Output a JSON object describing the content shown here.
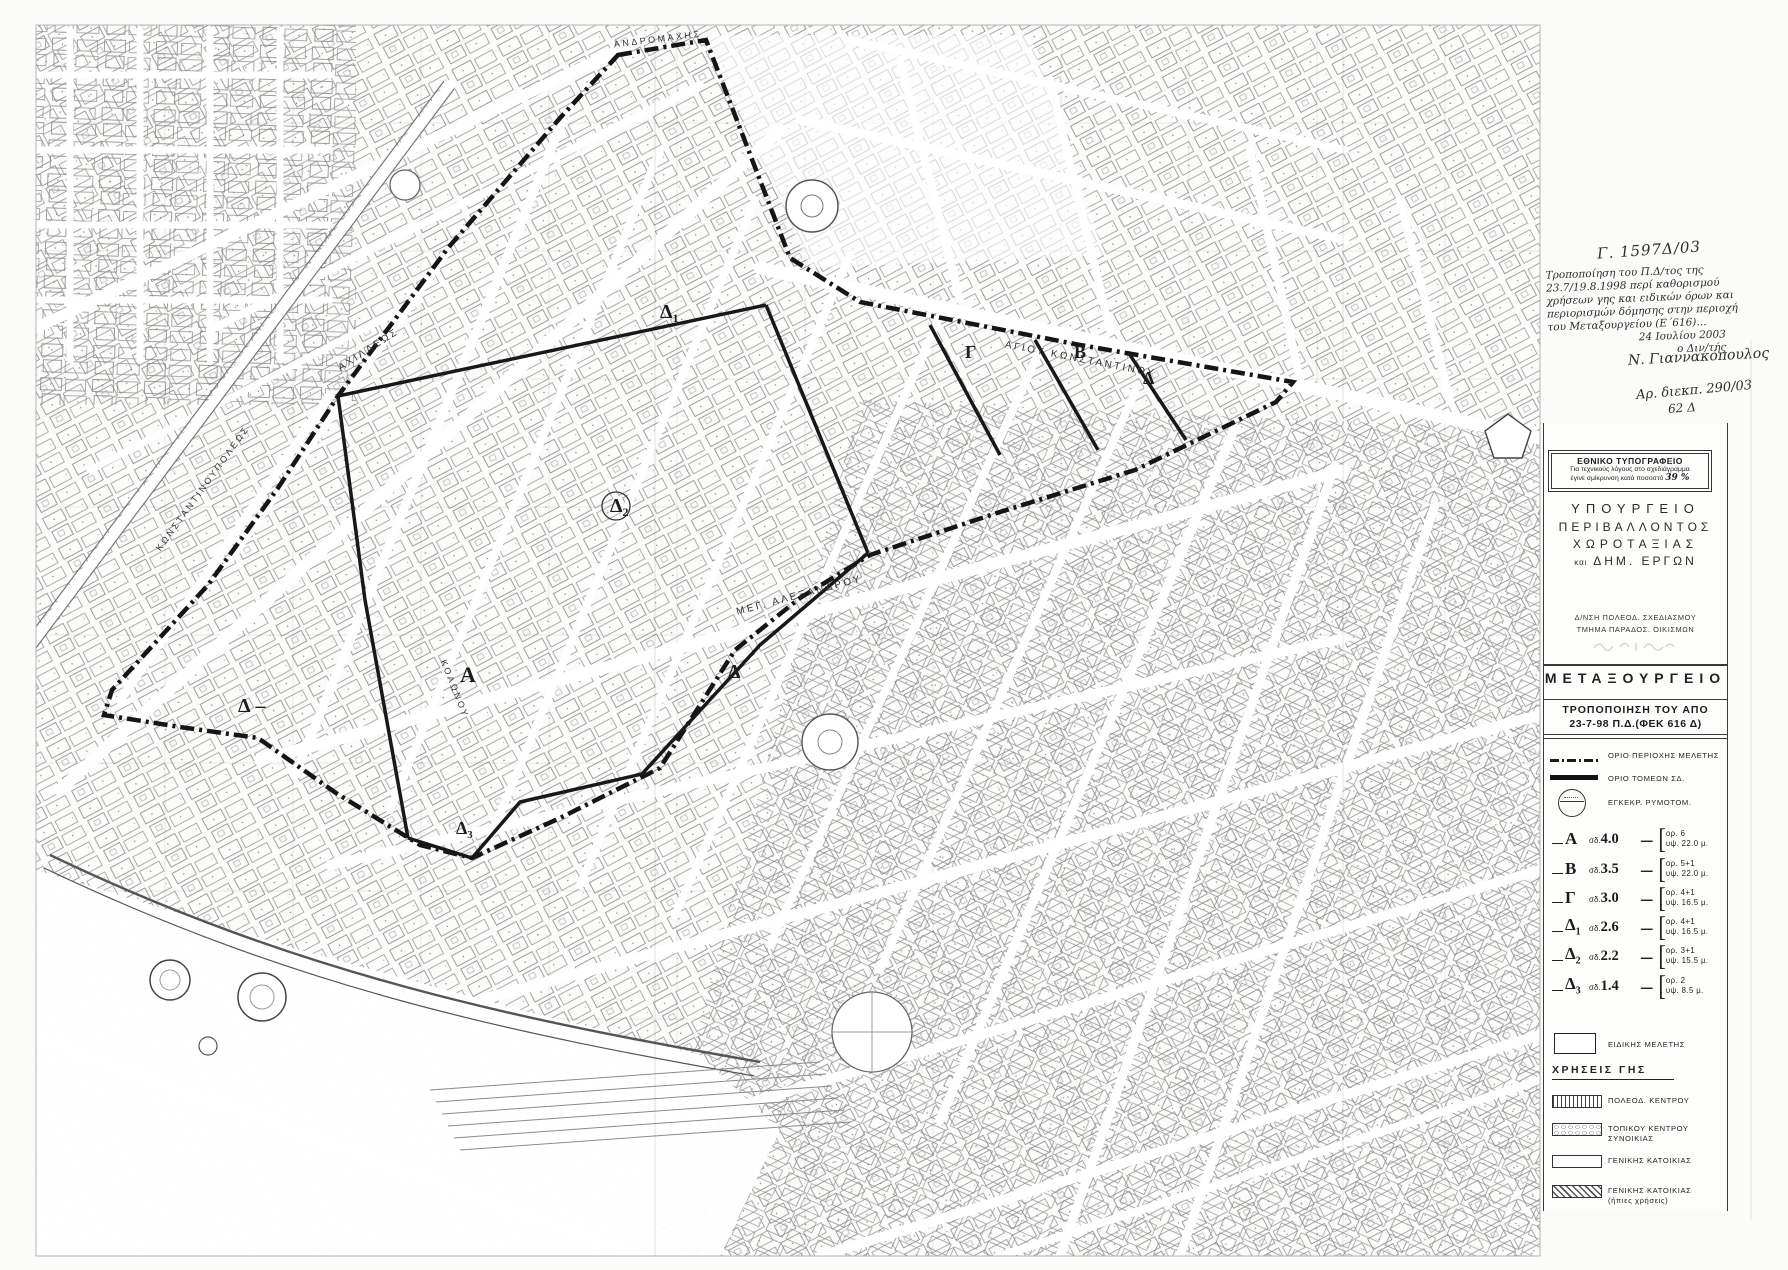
{
  "colors": {
    "ink": "#1b1b1b",
    "scan_gray": "#6b6b6b",
    "paper": "#fbfbfa",
    "boundary": "#151515"
  },
  "annotations": {
    "ref_number": "Γ. 1597Δ/03",
    "note_lines": [
      "Τροποποίηση του Π.Δ/τος της",
      "23.7/19.8.1998 περί καθορισμού",
      "χρήσεων γης και ειδικών όρων και",
      "περιορισμών δόμησης στην περιοχή",
      "του Μεταξουργείου (Ε΄616)..."
    ],
    "note_right_lines": [
      "24 Ιουλίου 2003",
      "ο Διν/τής"
    ],
    "signature": "Ν. Γιαννακόπουλος",
    "docket": "Αρ. διεκπ. 290/03",
    "docket2": "62 Δ"
  },
  "stamp": {
    "line1": "ΕΘΝΙΚΟ ΤΥΠΟΓΡΑΦΕΙΟ",
    "line2": "Για τεχνικούς λόγους στο σχεδιάγραμμα",
    "line3": "έγινε σμίκρυνση κατά ποσοστό",
    "percent": "39 %"
  },
  "title_block": {
    "ministry_line1": "ΥΠΟΥΡΓΕΙΟ",
    "ministry_line2": "ΠΕΡΙΒΑΛΛΟΝΤΟΣ",
    "ministry_line3": "ΧΩΡΟΤΑΞΙΑΣ",
    "ministry_line4_small": "και",
    "ministry_line4": "ΔΗΜ. ΕΡΓΩΝ",
    "dept_line1": "Δ/ΝΣΗ ΠΟΛΕΟΔ. ΣΧΕΔΙΑΣΜΟΥ",
    "dept_line2": "ΤΜΗΜΑ ΠΑΡΑΔΟΣ. ΟΙΚΙΣΜΩΝ",
    "project": "ΜΕΤΑΞΟΥΡΓΕΙΟ",
    "subtitle1": "ΤΡΟΠΟΠΟΙΗΣΗ ΤΟΥ ΑΠΟ",
    "subtitle2": "23-7-98 Π.Δ.(ΦΕΚ 616 Δ)"
  },
  "legend": {
    "boundary_items": [
      {
        "symbol": "dash-dot-line",
        "label": "ΟΡΙΟ ΠΕΡΙΟΧΗΣ ΜΕΛΕΤΗΣ"
      },
      {
        "symbol": "thick-line",
        "label": "ΟΡΙΟ ΤΟΜΕΩΝ ΣΔ."
      },
      {
        "symbol": "approval-seal",
        "label": "ΕΓΚΕΚΡ. ΡΥΜΟΤΟΜ."
      }
    ],
    "sd_prefix": "σδ.",
    "zones": [
      {
        "zone": "Α",
        "sub": "",
        "sd": "4.0",
        "floors": "ορ. 6",
        "height": "υψ. 22.0 μ."
      },
      {
        "zone": "Β",
        "sub": "",
        "sd": "3.5",
        "floors": "ορ. 5+1",
        "height": "υψ. 22.0 μ."
      },
      {
        "zone": "Γ",
        "sub": "",
        "sd": "3.0",
        "floors": "ορ. 4+1",
        "height": "υψ. 16.5 μ."
      },
      {
        "zone": "Δ",
        "sub": "1",
        "sd": "2.6",
        "floors": "ορ. 4+1",
        "height": "υψ. 16.5 μ."
      },
      {
        "zone": "Δ",
        "sub": "2",
        "sd": "2.2",
        "floors": "ορ. 3+1",
        "height": "υψ. 15.5 μ."
      },
      {
        "zone": "Δ",
        "sub": "3",
        "sd": "1.4",
        "floors": "ορ. 2",
        "height": "υψ. 8.5 μ."
      }
    ],
    "special_item_label": "ΕΙΔΙΚΗΣ ΜΕΛΕΤΗΣ",
    "land_use_header": "ΧΡΗΣΕΙΣ ΓΗΣ",
    "land_uses": [
      {
        "pattern": "pat-vhatch",
        "label": "ΠΟΛΕΟΔ. ΚΕΝΤΡΟΥ",
        "label2": ""
      },
      {
        "pattern": "pat-ovals",
        "label": "ΤΟΠΙΚΟΥ ΚΕΝΤΡΟΥ",
        "label2": "ΣΥΝΟΙΚΙΑΣ"
      },
      {
        "pattern": "",
        "label": "ΓΕΝΙΚΗΣ ΚΑΤΟΙΚΙΑΣ",
        "label2": ""
      },
      {
        "pattern": "pat-diag",
        "label": "ΓΕΝΙΚΗΣ ΚΑΤΟΙΚΙΑΣ",
        "label2": "(ήπιες χρήσεις)"
      }
    ]
  },
  "map": {
    "street_labels": [
      {
        "text": "ΑΝΔΡΟΜΑΧΗΣ",
        "x": 658,
        "y": 42,
        "a": -7,
        "s": 9
      },
      {
        "text": "ΑΓΙΟΥ ΚΩΝΣΤΑΝΤΙΝΟΥ",
        "x": 1080,
        "y": 362,
        "a": 11,
        "s": 10
      },
      {
        "text": "ΜΕΓ. ΑΛΕΞΑΝΔΡΟΥ",
        "x": 800,
        "y": 598,
        "a": -15,
        "s": 10
      },
      {
        "text": "ΑΧΙΛΛΕΩΣ",
        "x": 370,
        "y": 352,
        "a": -33,
        "s": 10
      },
      {
        "text": "ΚΩΝΣΤΑΝΤΙΝΟΥΠΟΛΕΩΣ",
        "x": 205,
        "y": 490,
        "a": -54,
        "s": 9
      },
      {
        "text": "ΚΟΛΩΝΟΥ",
        "x": 452,
        "y": 690,
        "a": 68,
        "s": 9
      }
    ],
    "zone_labels": [
      {
        "t": "Δ",
        "sub": "1",
        "x": 660,
        "y": 318,
        "s": 20,
        "circle": false,
        "dash": false
      },
      {
        "t": "Δ",
        "sub": "2",
        "x": 610,
        "y": 512,
        "s": 20,
        "circle": true,
        "dash": false
      },
      {
        "t": "Α",
        "sub": "",
        "x": 460,
        "y": 682,
        "s": 22,
        "circle": false,
        "dash": false
      },
      {
        "t": "Δ",
        "sub": "",
        "x": 728,
        "y": 678,
        "s": 20,
        "circle": false,
        "dash": false
      },
      {
        "t": "Δ",
        "sub": "",
        "x": 238,
        "y": 712,
        "s": 20,
        "circle": false,
        "dash": true
      },
      {
        "t": "Δ",
        "sub": "3",
        "x": 456,
        "y": 834,
        "s": 18,
        "circle": false,
        "dash": false
      },
      {
        "t": "Γ",
        "sub": "",
        "x": 965,
        "y": 358,
        "s": 18,
        "circle": false,
        "dash": false
      },
      {
        "t": "Β",
        "sub": "",
        "x": 1074,
        "y": 358,
        "s": 18,
        "circle": false,
        "dash": false
      },
      {
        "t": "Δ",
        "sub": "",
        "x": 1143,
        "y": 384,
        "s": 18,
        "circle": false,
        "dash": false
      }
    ]
  }
}
